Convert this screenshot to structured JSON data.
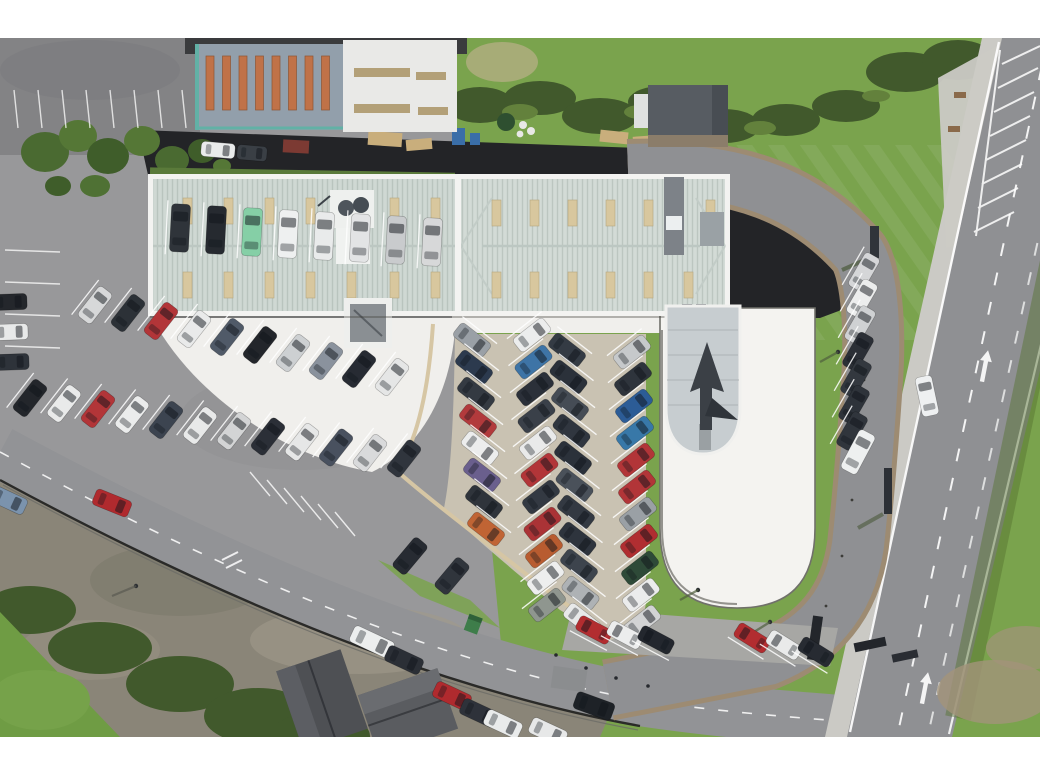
{
  "meta": {
    "description": "Aerial drone photograph, looking straight down, of a car dealership: a long showroom building with pale corrugated roof, a white display apron, herringbone rows of cars for sale, a white oval delivery pad with glass entrance canopy and arrow sculpture, perimeter loop road, grass verges, a main road with hatched markings on the right, industrial units at top and houses at bottom"
  },
  "frame": {
    "letterbox_top_px": 38,
    "letterbox_bottom_px": 43
  },
  "palette": {
    "letterbox": "#ffffff",
    "asphalt": "#98989a",
    "asphalt_dark": "#232427",
    "road": "#8f9093",
    "street": "#929396",
    "sidewalk": "#cbcac5",
    "lot_weathered": "#8a8578",
    "grass": "#7aa34d",
    "hedge": "#41592c",
    "tree": "#4c6b33",
    "dirt": "#a3937a",
    "roof_main": "#cfd8d3",
    "roof_main_right": "#d3dbd6",
    "roof_ridge": "#bcc7c2",
    "parapet": "#f3f3f1",
    "skylight": "#d8c79e",
    "roof_blue": "#929fab",
    "skylight_orange": "#c07248",
    "teal_trim": "#62b1a6",
    "roof_white": "#e9e9e7",
    "vent_tan": "#b3a078",
    "roof_small_building": "#575c62",
    "pad_white": "#f4f3f0",
    "apron": "#f0efec",
    "lot_tan": "#c9c2b2",
    "curb_tan": "#d6c6a4",
    "shoulder_brown": "#9d8b72",
    "canopy_glass": "#c7cdd0",
    "line_white": "#ffffff",
    "sculpture_dark": "#3b4046"
  },
  "cars": {
    "car_groups": [
      {
        "name": "top-left-van-row",
        "x": 180,
        "y": 228,
        "dx": 36,
        "dy": 2,
        "angle": 3,
        "w": 19,
        "l": 48,
        "bays": true,
        "colors": [
          "#2f343a",
          "#262a30",
          "#85cfa6",
          "#eef0f0",
          "#e9ebeb",
          "#e3e4e5",
          "#c9cbcd",
          "#d7d8d9"
        ]
      },
      {
        "name": "left-edge-column",
        "x": 10,
        "y": 302,
        "dx": 1,
        "dy": 30,
        "angle": 88,
        "w": 16,
        "l": 34,
        "colors": [
          "#24272c",
          "#e8e9e9",
          "#2e333a"
        ]
      },
      {
        "name": "left-echelon-row-upper",
        "x": 95,
        "y": 305,
        "dx": 33,
        "dy": 8,
        "angle": 38,
        "w": 17,
        "l": 38,
        "bays": true,
        "colors": [
          "#d7d8d9",
          "#2c3137",
          "#b23538",
          "#e9eaea",
          "#505a68",
          "#23262b",
          "#cdd0d2",
          "#8a929d",
          "#272b33",
          "#e5e6e6"
        ]
      },
      {
        "name": "left-echelon-row-lower",
        "x": 30,
        "y": 398,
        "dx": 34,
        "dy": 5.5,
        "angle": 38,
        "w": 17,
        "l": 38,
        "bays": true,
        "colors": [
          "#23262b",
          "#e9eaea",
          "#b23538",
          "#ebecec",
          "#3c4450",
          "#e8e9e9",
          "#d3d4d5",
          "#2b2f37",
          "#e6e7e7",
          "#49515f",
          "#d9dadb",
          "#30353d"
        ]
      },
      {
        "name": "display-column-1",
        "x": 472,
        "y": 340,
        "dx": 2,
        "dy": 27,
        "angle": 128,
        "w": 17,
        "l": 38,
        "bays": true,
        "colors": [
          "#9aa0a6",
          "#2c3a4e",
          "#343a42",
          "#b23a3c",
          "#eceded",
          "#6a5f8d",
          "#2f343b",
          "#c06434"
        ]
      },
      {
        "name": "display-column-2",
        "x": 532,
        "y": 335,
        "dx": 1.5,
        "dy": 27,
        "angle": 52,
        "w": 17,
        "l": 38,
        "bays": true,
        "colors": [
          "#eceded",
          "#3e74a6",
          "#2b3039",
          "#3a4049",
          "#e9eaea",
          "#b23538",
          "#333942",
          "#aa3336",
          "#b85c30",
          "#edeeee",
          "#8f968f"
        ]
      },
      {
        "name": "display-column-3",
        "x": 567,
        "y": 350,
        "dx": 1.5,
        "dy": 27,
        "angle": 128,
        "w": 17,
        "l": 38,
        "bays": true,
        "colors": [
          "#343b44",
          "#2b313a",
          "#454c55",
          "#30363f",
          "#2b313a",
          "#4a515a",
          "#333942",
          "#2e343d",
          "#3d444d",
          "#aeb2b5",
          "#e8e9e9"
        ]
      },
      {
        "name": "display-column-4",
        "x": 632,
        "y": 352,
        "dx": 1,
        "dy": 27,
        "angle": 52,
        "w": 17,
        "l": 38,
        "bays": true,
        "colors": [
          "#c6c9cb",
          "#2e343c",
          "#2c5c96",
          "#3878a8",
          "#b23538",
          "#b23538",
          "#9aa0a5",
          "#b02e31",
          "#2e4a38",
          "#ebecec",
          "#d2d3d4"
        ]
      },
      {
        "name": "right-echelon-column",
        "x": 864,
        "y": 272,
        "dx": -2,
        "dy": 26.5,
        "angle": 30,
        "w": 17,
        "l": 38,
        "bays": true,
        "colors": [
          "#d5d6d8",
          "#eceded",
          "#cfd1d3",
          "#2b2f36",
          "#33383f",
          "#2e333a",
          "#30353c"
        ]
      },
      {
        "name": "right-white-van",
        "x": 858,
        "y": 452,
        "angle": 28,
        "w": 18,
        "l": 44,
        "colors": [
          "#eef0f0"
        ]
      },
      {
        "name": "bottom-bays-a",
        "x": 594,
        "y": 630,
        "dx": 31,
        "dy": 5,
        "angle": -62,
        "w": 16,
        "l": 36,
        "bays": true,
        "colors": [
          "#b22d30",
          "#eceded",
          "#23272e"
        ]
      },
      {
        "name": "bottom-bays-b",
        "x": 752,
        "y": 638,
        "dx": 32,
        "dy": 7,
        "angle": -58,
        "w": 16,
        "l": 36,
        "bays": true,
        "colors": [
          "#b22d30",
          "#e9eaea",
          "#272b32"
        ]
      },
      {
        "name": "street-parked-van",
        "x": 372,
        "y": 642,
        "angle": 115,
        "w": 18,
        "l": 44,
        "colors": [
          "#eceeee"
        ]
      },
      {
        "name": "street-parked-1",
        "x": 404,
        "y": 660,
        "angle": 115,
        "w": 17,
        "l": 38,
        "colors": [
          "#2b2f36"
        ]
      },
      {
        "name": "street-parked-2",
        "x": 452,
        "y": 696,
        "angle": 115,
        "w": 17,
        "l": 38,
        "colors": [
          "#b02a2e"
        ]
      },
      {
        "name": "street-parked-3",
        "x": 479,
        "y": 713,
        "angle": 115,
        "w": 17,
        "l": 38,
        "colors": [
          "#2e323a"
        ]
      },
      {
        "name": "street-parked-4",
        "x": 503,
        "y": 724,
        "angle": 115,
        "w": 17,
        "l": 38,
        "colors": [
          "#e9ebeb"
        ]
      },
      {
        "name": "street-parked-5",
        "x": 548,
        "y": 732,
        "angle": 115,
        "w": 17,
        "l": 38,
        "colors": [
          "#e7e8e8"
        ]
      },
      {
        "name": "verge-pair-1",
        "x": 410,
        "y": 556,
        "angle": 40,
        "w": 17,
        "l": 38,
        "colors": [
          "#272b32"
        ]
      },
      {
        "name": "verge-pair-2",
        "x": 452,
        "y": 576,
        "angle": 40,
        "w": 17,
        "l": 38,
        "colors": [
          "#30353c"
        ]
      },
      {
        "name": "driving-red-car",
        "x": 112,
        "y": 503,
        "angle": 112,
        "w": 17,
        "l": 38,
        "colors": [
          "#b02a2e"
        ]
      },
      {
        "name": "driving-black-suv",
        "x": 594,
        "y": 706,
        "angle": 110,
        "w": 18,
        "l": 40,
        "colors": [
          "#1e2227"
        ]
      },
      {
        "name": "driving-white-car-main-road",
        "x": 927,
        "y": 396,
        "angle": -12,
        "w": 17,
        "l": 40,
        "colors": [
          "#eef0f1"
        ]
      },
      {
        "name": "left-edge-blue-car",
        "x": 8,
        "y": 500,
        "angle": 115,
        "w": 17,
        "l": 38,
        "colors": [
          "#7b93ad"
        ]
      },
      {
        "name": "yard-van-1",
        "x": 218,
        "y": 150,
        "angle": 95,
        "w": 15,
        "l": 34,
        "colors": [
          "#e9ebeb"
        ]
      },
      {
        "name": "yard-van-2",
        "x": 252,
        "y": 153,
        "angle": 95,
        "w": 15,
        "l": 30,
        "colors": [
          "#3a3f45"
        ]
      }
    ]
  }
}
